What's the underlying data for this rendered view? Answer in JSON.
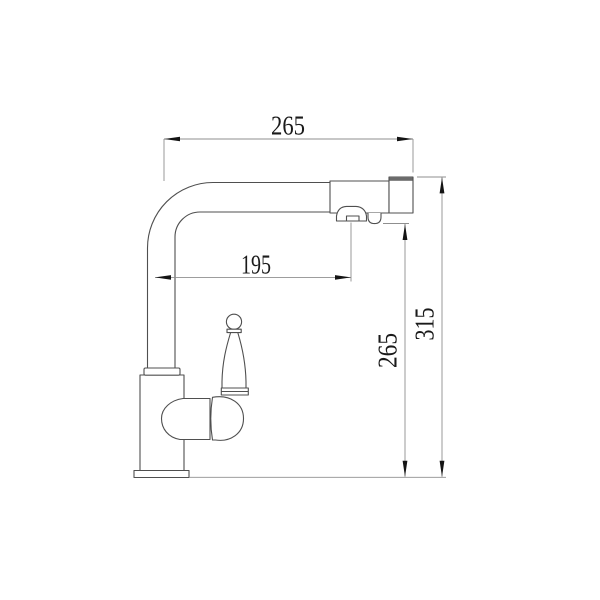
{
  "drawing": {
    "kind": "faucet technical line drawing, side elevation",
    "dimension_labels": {
      "top_width": "265",
      "spout_reach": "195",
      "outlet_height": "265",
      "overall_height": "315"
    },
    "colors": {
      "background": "#ffffff",
      "object_line": "#4f4f4f",
      "dimension_line": "#8f8f8f",
      "arrowhead": "#141414",
      "text": "#1a1a1a",
      "cap_band": "#6b6b6b"
    }
  }
}
